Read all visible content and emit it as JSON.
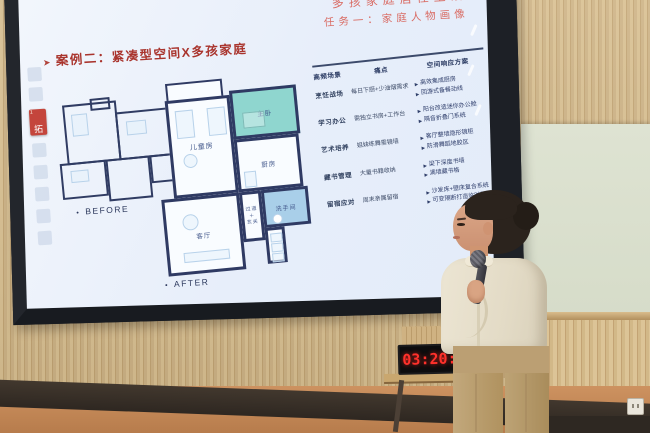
{
  "photo": {
    "clock_time": "03:20:5",
    "colors": {
      "clock_digits": "#ff312b",
      "slide_title_red": "#a9342d",
      "header_pink_red": "#d96c64",
      "plan_wall_navy": "#2f3a63",
      "master_bedroom_teal": "#8fd6cf",
      "bathroom_blue": "#a9cfe9",
      "wood_slats": "#cdb284",
      "floor_orange": "#c08552"
    }
  },
  "screen": {
    "header_line1": "多孩家庭居住生活",
    "header_line2": "任务一：家庭人物画像",
    "title_bullet": "➤",
    "title": "案例二：紧凑型空间X多孩家庭",
    "sidebar_tag": "拓",
    "sidebar_tag_badge": "1",
    "floorplan": {
      "marker": "•",
      "before_label": "BEFORE",
      "after_label": "AFTER",
      "rooms": {
        "kids": "儿童房",
        "master": "主卧",
        "kitchen": "厨房",
        "bath": "洗手间",
        "living": "客厅",
        "hallway": "过道\n＋\n玄关"
      }
    },
    "table": {
      "bullet": "▶",
      "headers": [
        "高频场景",
        "痛点",
        "空间响应方案"
      ],
      "rows": [
        {
          "scene": "烹饪战场",
          "pain": "每日下厨+少油烟需求",
          "solutions": [
            "高效集成厨房",
            "回游式备餐动线"
          ]
        },
        {
          "scene": "学习办公",
          "pain": "需独立书房+工作台",
          "solutions": [
            "阳台改造迷你办公舱",
            "隔音折叠门系统"
          ]
        },
        {
          "scene": "艺术培养",
          "pain": "姐妹练舞需镜墙",
          "solutions": [
            "客厅整墙隐形镜柜",
            "防滑舞蹈地胶区"
          ]
        },
        {
          "scene": "藏书管理",
          "pain": "大量书籍收纳",
          "solutions": [
            "梁下深度书墙",
            "满墙藏书格"
          ]
        },
        {
          "scene": "留宿应对",
          "pain": "周末亲属留宿",
          "solutions": [
            "沙发床+壁床复合系统",
            "可变隔断打造临时卧室"
          ]
        }
      ]
    }
  }
}
